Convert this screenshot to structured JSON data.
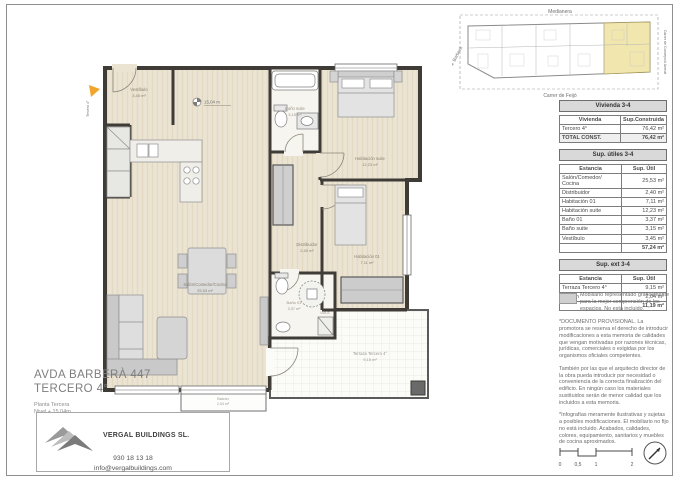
{
  "sheet": {
    "project_title_line1": "AVDA BARBERÀ 447",
    "project_title_line2": "TERCERO 4°",
    "floor_label": "Planta Tercera",
    "level_label": "Nivel + 15,04m",
    "company_name": "VERGAL BUILDINGS SL.",
    "phone": "930 18 13 18",
    "email": "info@vergalbuildings.com"
  },
  "site_plan": {
    "label_top": "Medianera",
    "label_left": "Av. Barberà",
    "label_right": "Carrer de Concepció Arenal",
    "label_bottom": "Carrer de Feijó",
    "highlight_color": "#f1e7ae"
  },
  "floor_plan": {
    "entry_marker": "Tercero 4°",
    "level_marker": "15,04 m",
    "closet_label": "LV/LS",
    "rooms": {
      "vestibulo": {
        "name": "Vestíbulo",
        "area": "3,45 m²"
      },
      "bano_suite": {
        "name": "Baño suite",
        "area": "3,15 m²"
      },
      "habitacion_suite": {
        "name": "Habitación suite",
        "area": "12,23 m²"
      },
      "distribuidor": {
        "name": "Distribuidor",
        "area": "2,40 m²"
      },
      "habitacion_01": {
        "name": "Habitación 01",
        "area": "7,11 m²"
      },
      "bano_01": {
        "name": "Baño 01",
        "area": "3,37 m²"
      },
      "salon": {
        "name": "Salón/Comedor/Cocina",
        "area": "25,53 m²"
      },
      "terraza": {
        "name": "Terraza Tercero 4°",
        "area": "9,15 m²"
      },
      "balcon": {
        "name": "Balcón",
        "area": "2,04 m²"
      }
    },
    "colors": {
      "floor": "#ece4d3",
      "wall": "#3f3c38",
      "furniture": "#d9d9d9"
    }
  },
  "tables": {
    "vivienda": {
      "title": "Vivienda 3-4",
      "col1": "Vivienda",
      "col2": "Sup.Construida",
      "rows": [
        [
          "Tercero 4°",
          "76,42 m²"
        ]
      ],
      "total_label": "TOTAL CONST.",
      "total_value": "76,42 m²"
    },
    "utiles": {
      "title": "Sup. útiles 3-4",
      "col1": "Estancia",
      "col2": "Sup. Útil",
      "rows": [
        [
          "Salón/Comedor/ Cocina",
          "25,53 m²"
        ],
        [
          "Distribuidor",
          "2,40 m²"
        ],
        [
          "Habitación 01",
          "7,11 m²"
        ],
        [
          "Habitación suite",
          "12,23 m²"
        ],
        [
          "Baño 01",
          "3,37 m²"
        ],
        [
          "Baño suite",
          "3,15 m²"
        ],
        [
          "Vestíbulo",
          "3,45 m²"
        ]
      ],
      "total_value": "57,24 m²"
    },
    "ext": {
      "title": "Sup. ext 3-4",
      "col1": "Estancia",
      "col2": "Sup. Útil",
      "rows": [
        [
          "Terraza Tercero 4°",
          "9,15 m²"
        ],
        [
          "Balcón",
          "2,04 m²"
        ]
      ],
      "total_value": "11,19 m²"
    }
  },
  "notes": {
    "furniture": "Mobiliario representado gráficamente para la mejor comprensión de los espacios. No está incluido.",
    "p1": "*DOCUMENTO PROVISIONAL. La promotora se reserva el derecho de introducir modificaciones a esta memoria de calidades que vengan motivadas por razones técnicas, jurídicas, comerciales o exigidas por los organismos oficiales competentes.",
    "p2": "También por las que el arquitecto director de la obra pueda introducir por necesidad o conveniencia de la correcta finalización del edificio. En ningún caso los materiales sustituidos serán de menor calidad que los incluidos a esta memoria.",
    "p3": "*Infografías meramente ilustrativas y sujetas a posibles modificaciones. El mobiliario no fijo no está incluido. Acabados, calidades, colores, equipamiento, sanitarios y muebles de cocina aproximados."
  },
  "scale_bar": {
    "t0": "0",
    "t05": "0,5",
    "t1": "1",
    "t2": "2"
  }
}
